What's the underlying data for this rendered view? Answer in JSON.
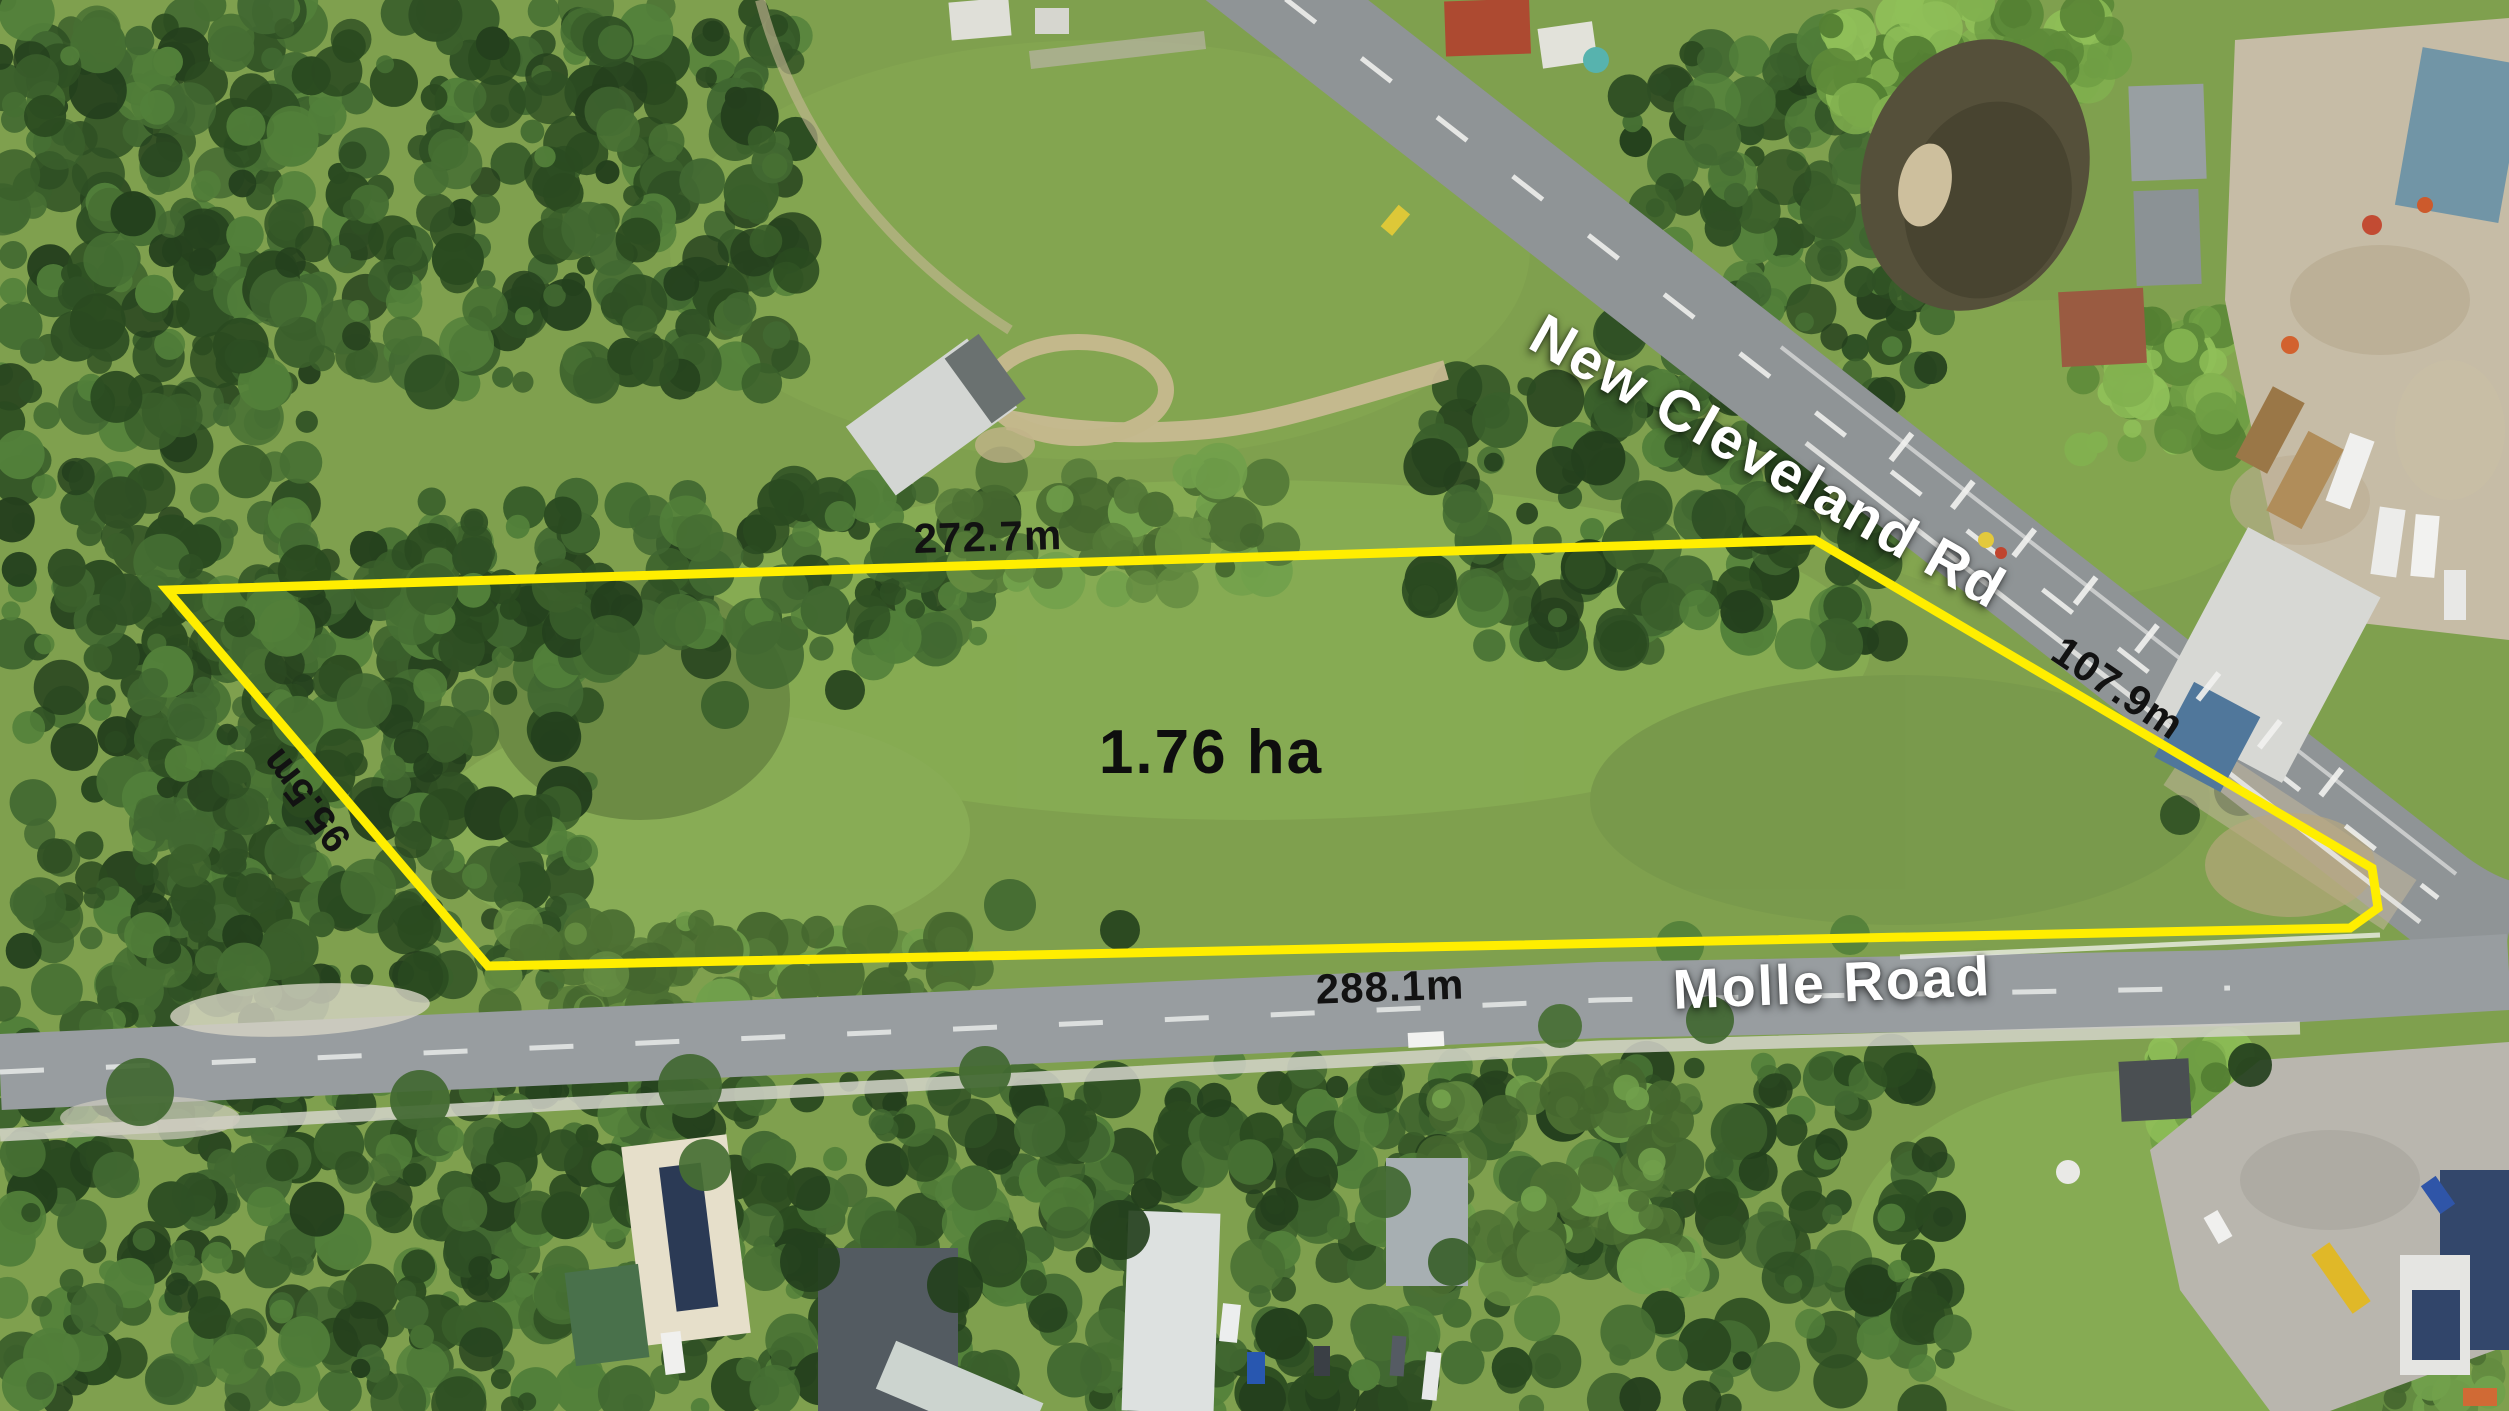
{
  "property": {
    "area_label": "1.76 ha",
    "boundary_color": "#ffee00",
    "sides": {
      "top": "272.7m",
      "left": "95.5m",
      "right": "107.9m",
      "bottom": "288.1m"
    }
  },
  "roads": {
    "new_cleveland": "New Cleveland Rd",
    "molle": "Molle Road"
  },
  "colors": {
    "measurement_text": "#121212",
    "road_text": "#ffffff"
  }
}
